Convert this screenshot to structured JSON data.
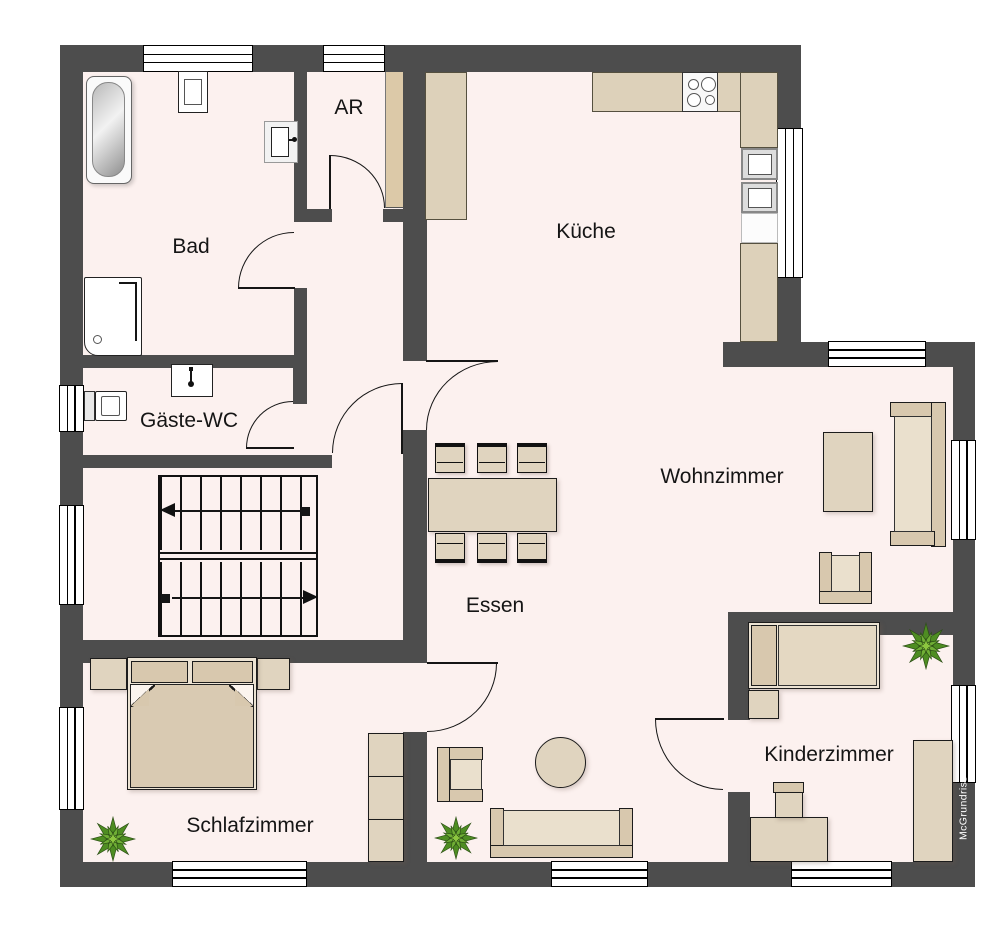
{
  "rooms": {
    "bad": {
      "label": "Bad"
    },
    "ar": {
      "label": "AR"
    },
    "kueche": {
      "label": "Küche"
    },
    "gaeste_wc": {
      "label": "Gäste-WC"
    },
    "wohnzimmer": {
      "label": "Wohnzimmer"
    },
    "essen": {
      "label": "Essen"
    },
    "schlafzimmer": {
      "label": "Schlafzimmer"
    },
    "kinderzimmer": {
      "label": "Kinderzimmer"
    }
  },
  "watermark": {
    "label": "McGrundriss"
  },
  "colors": {
    "wall": "#4d4d4d",
    "floor": "#fcf1ef",
    "outside": "#ffffff",
    "furniture": "#e0d4bf",
    "furniture_dark": "#d8c8ae",
    "counter": "#ddd1ba",
    "outline": "#1c1c1c",
    "plant_green": "#5a9e2f"
  }
}
